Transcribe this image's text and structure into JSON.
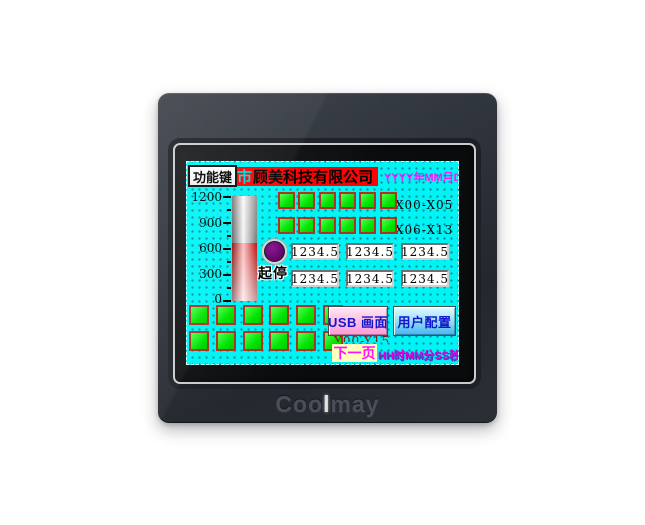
{
  "device": {
    "logo": {
      "pre": "Coo",
      "highlight": "l",
      "post": "may"
    }
  },
  "display": {
    "function_key_label": "功能键",
    "company_banner": {
      "prefix": "市",
      "name": "顾美科技有限公司"
    },
    "date_text": "YYYY年MM月DD日",
    "time_text": "HH时MM分SS秒",
    "start_stop_label": "起停",
    "usb_button_label": "USB 画面",
    "user_config_button_label": "用户配置",
    "next_page_label": "下一页",
    "clipped_output_label": "Y00-Y15",
    "gauge": {
      "min": 0,
      "max": 1200,
      "tick_labels": [
        "1200",
        "900",
        "600",
        "300",
        "0"
      ],
      "fill_percent": 55
    },
    "input_indicator_rows": [
      {
        "label": "X00-X05",
        "count": 6
      },
      {
        "label": "X06-X13",
        "count": 6
      }
    ],
    "numeric_displays": {
      "values": [
        "1234.5",
        "1234.5",
        "1234.5",
        "1234.5",
        "1234.5",
        "1234.5"
      ]
    },
    "output_indicator_grid": {
      "rows": 2,
      "cols": 6
    },
    "colors": {
      "screen_bg": "#00f4f4",
      "indicator_green": "#00e400",
      "indicator_border": "#ad3224",
      "banner_red": "#fe0000",
      "accent_magenta": "#ff10ff",
      "button_text_blue": "#1515cc"
    }
  }
}
